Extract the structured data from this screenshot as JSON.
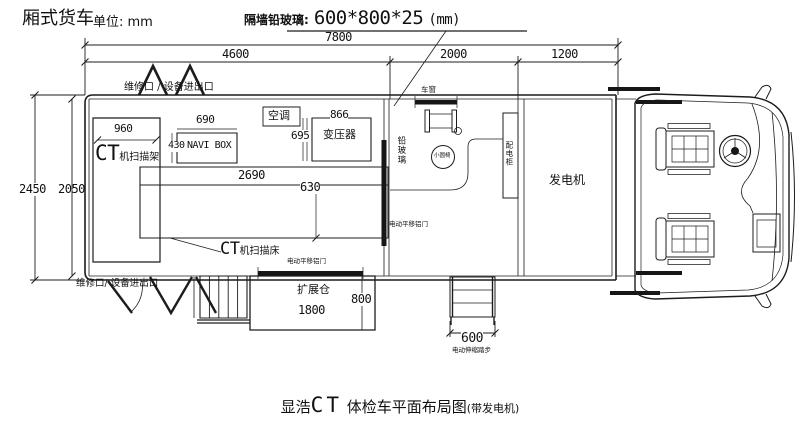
{
  "header": {
    "vehicle_type": "厢式货车",
    "unit": "单位: mm",
    "glass_note_prefix": "隔墙铅玻璃:",
    "glass_note_size": "600*800*25",
    "glass_note_suffix": "(mm)"
  },
  "dims": {
    "total_length": "7800",
    "ct_room": "4600",
    "control_room": "2000",
    "generator_room": "1200",
    "width_outer": "2450",
    "width_inner": "2050",
    "gantry_width": "960",
    "navi_width": "690",
    "navi_depth": "430",
    "transformer_width": "866",
    "transformer_depth": "695",
    "bed_length": "2690",
    "bed_width": "630",
    "expansion_length": "1800",
    "expansion_depth": "800",
    "steps_width": "600"
  },
  "equipment": {
    "ct_en": "CT",
    "gantry_cn": "机扫描架",
    "bed_cn": "机扫描床",
    "navi_box": "NAVI BOX",
    "ac": "空调",
    "transformer": "变压器",
    "window": "车窗",
    "partition_glass": "铅玻璃",
    "round_stool": "小圆椅",
    "dist_cabinet": "配电柜",
    "generator": "发电机",
    "expansion_bay": "扩展仓"
  },
  "doors": {
    "top_access": "维修口 / 设备进出口",
    "bottom_access": "维修口/ 设备进出口",
    "sliding_door": "电动平移铝门",
    "steps": "电动伸缩踏步"
  },
  "caption": {
    "prefix": "显浩",
    "ct": "CT",
    "main": " 体检车平面布局图",
    "suffix": "(带发电机)"
  }
}
